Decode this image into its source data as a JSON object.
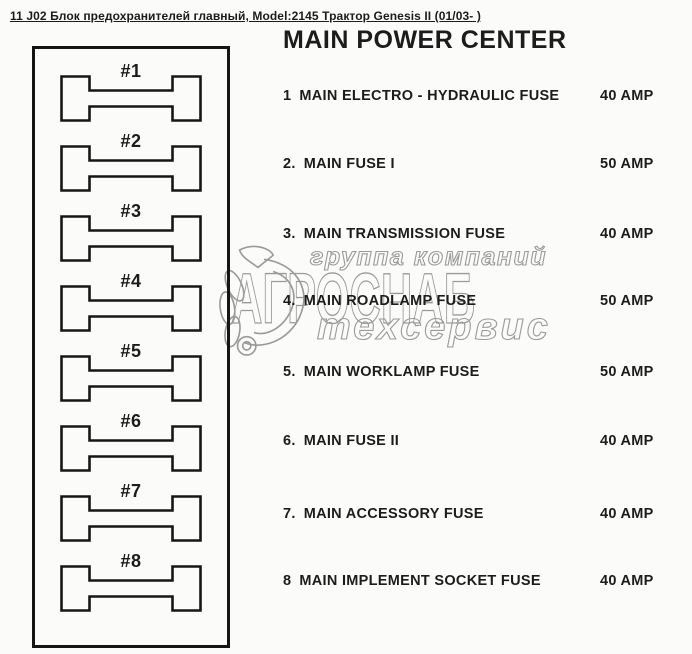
{
  "page": {
    "header": "11 J02 Блок предохранителей главный, Model:2145 Трактор Genesis II (01/03- )",
    "title": "MAIN POWER CENTER"
  },
  "fuse_diagram": {
    "fuses": [
      {
        "label": "#1"
      },
      {
        "label": "#2"
      },
      {
        "label": "#3"
      },
      {
        "label": "#4"
      },
      {
        "label": "#5"
      },
      {
        "label": "#6"
      },
      {
        "label": "#7"
      },
      {
        "label": "#8"
      }
    ]
  },
  "fuse_list": {
    "items": [
      {
        "number": "1",
        "name": "MAIN ELECTRO - HYDRAULIC FUSE",
        "rating": "40 AMP"
      },
      {
        "number": "2.",
        "name": "MAIN FUSE I",
        "rating": "50 AMP"
      },
      {
        "number": "3.",
        "name": "MAIN TRANSMISSION FUSE",
        "rating": "40 AMP"
      },
      {
        "number": "4.",
        "name": "MAIN ROADLAMP FUSE",
        "rating": "50 AMP"
      },
      {
        "number": "5.",
        "name": "MAIN WORKLAMP FUSE",
        "rating": "50 AMP"
      },
      {
        "number": "6.",
        "name": "MAIN FUSE II",
        "rating": "40 AMP"
      },
      {
        "number": "7.",
        "name": "MAIN ACCESSORY FUSE",
        "rating": "40 AMP"
      },
      {
        "number": "8",
        "name": "MAIN IMPLEMENT SOCKET FUSE",
        "rating": "40 AMP"
      }
    ]
  },
  "watermark": {
    "line1": "группа компаний",
    "line2": "АГРОСНАБ",
    "line3": "техсервис"
  },
  "colors": {
    "ink": "#1c1c1c",
    "watermark": "#9a9a9a",
    "background": "#fbfbfa"
  }
}
